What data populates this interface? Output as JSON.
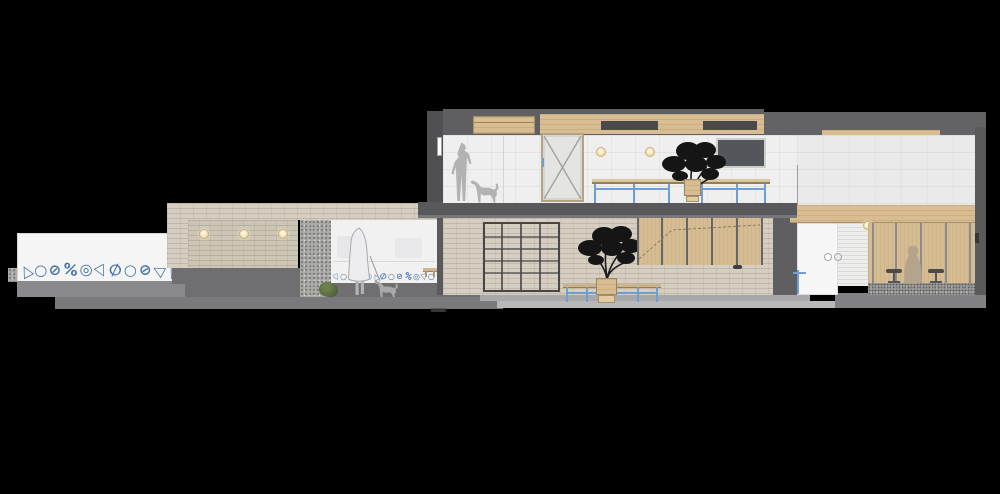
{
  "meta": {
    "title": "Two-storey interior section elevation drawing",
    "drawing_type": "architectural section render on black background"
  },
  "palette": {
    "background": "#000000",
    "accent_blue_furniture": "#6f9fd0",
    "pattern_blue": "#4874a6",
    "brick_beige": "#d5cec1",
    "wood_tan": "#d8bd92",
    "wall_white": "#efefef",
    "concrete_dark_gray": "#5f5f62",
    "ground_gray": "#6f6f71",
    "foliage_black": "#151515",
    "warm_light": "#f3e2bd",
    "figure_gray": "#b2b2b4",
    "figure_brown": "#b5a48c",
    "shrub_green": "#566b3f",
    "tv_screen": "#53565a"
  },
  "decor": {
    "frieze_left_glyphs": "△○⊘%◎▽∅○⊘◁△%",
    "frieze_room_glyphs": "▽○⊘%◎△∅○⊘%◎▽○"
  },
  "counts": {
    "brick_wall_lights": 3,
    "upper_wall_lights": 2,
    "bar_stools": 2,
    "trees": 2,
    "human_figures": 3,
    "dogs": 2
  },
  "inventory": {
    "upper_floor": "standing person with dog, x-braced door, two round lights, wall screen, potted tree on long blue-legged table, wood soffit cabinets",
    "lower_floor": "brick wall with three lights, terrazzo pier, shrub, veiled figure walking a dog over patterned frieze, grid shelving, potted tree with blue bench, wood panel wardrobe, white sliding door with round pulls, slat wall with bar stools and seated figure",
    "left_wall": "white garden wall with blue geometric frieze"
  }
}
